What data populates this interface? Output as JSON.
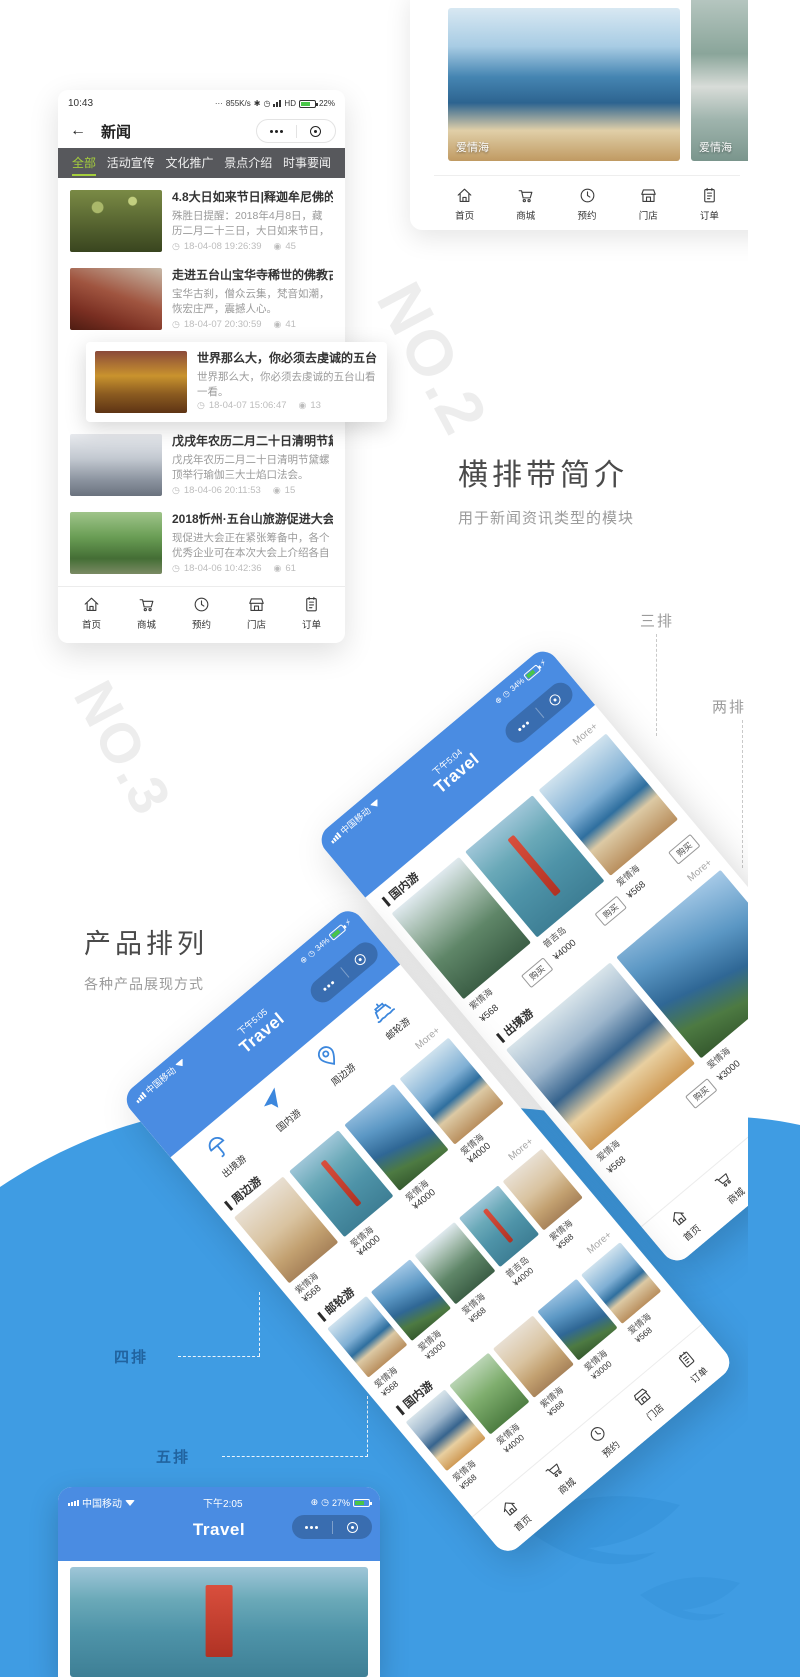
{
  "glyphs": {
    "star": "✱",
    "clock": "◷",
    "plus": "⊕",
    "eye": "◉",
    "meta_clock": "◷",
    "bolt": "⚡"
  },
  "no2": {
    "watermark": "NO.2",
    "title": "横排带简介",
    "subtitle": "用于新闻资讯类型的模块"
  },
  "no3": {
    "watermark": "NO.3",
    "title": "产品排列",
    "subtitle": "各种产品展现方式"
  },
  "annotations": {
    "three": "三排",
    "two": "两排",
    "four": "四排",
    "five": "五排"
  },
  "news_phone": {
    "status": {
      "time": "10:43",
      "dots": "···",
      "speed": "855K/s",
      "network": "HD",
      "battery": "22%"
    },
    "navbar": {
      "back": "←",
      "title": "新闻"
    },
    "tabs": [
      {
        "label": "全部"
      },
      {
        "label": "活动宣传"
      },
      {
        "label": "文化推广"
      },
      {
        "label": "景点介绍"
      },
      {
        "label": "时事要闻"
      }
    ],
    "items": [
      {
        "title": "4.8大日如来节日|释迦牟尼佛的清净报",
        "desc": "殊胜日提醒：2018年4月8日，藏历二月二十三日，大日如来节日，作何善恶成亿倍!",
        "time": "18-04-08 19:26:39",
        "views": "45"
      },
      {
        "title": "走进五台山宝华寺稀世的佛教古建筑",
        "desc": "宝华古刹，僧众云集，梵音如潮，恢宏庄严，震撼人心。",
        "time": "18-04-07 20:30:59",
        "views": "41"
      },
      {
        "title": "世界那么大，你必须去虔诚的五台山看",
        "desc": "世界那么大，你必须去虔诚的五台山看一看。",
        "time": "18-04-07 15:06:47",
        "views": "13"
      },
      {
        "title": "戊戌年农历二月二十日清明节黛螺顶举",
        "desc": "戊戌年农历二月二十日清明节黛螺顶举行瑜伽三大士焰口法会。",
        "time": "18-04-06 20:11:53",
        "views": "15"
      },
      {
        "title": "2018忻州·五台山旅游促进大会即将召",
        "desc": "现促进大会正在紧张筹备中，各个优秀企业可在本次大会上介绍各自的企业文化等，大",
        "time": "18-04-06 10:42:36",
        "views": "61"
      }
    ],
    "nav": [
      {
        "label": "首页"
      },
      {
        "label": "商城"
      },
      {
        "label": "预约"
      },
      {
        "label": "门店"
      },
      {
        "label": "订单"
      }
    ]
  },
  "gallery_phone": {
    "cards": [
      {
        "label": "爱情海"
      },
      {
        "label": "爱情海"
      }
    ],
    "nav": [
      {
        "label": "首页"
      },
      {
        "label": "商城"
      },
      {
        "label": "预约"
      },
      {
        "label": "门店"
      },
      {
        "label": "订单"
      }
    ]
  },
  "phone_a": {
    "status": {
      "carrier": "中国移动",
      "time": "下午5:04",
      "battery": "34%"
    },
    "title": "Travel",
    "sections": [
      {
        "name": "国内游",
        "more": "More+",
        "products": [
          {
            "name": "紫情海",
            "price": "¥568",
            "buy": "购买"
          },
          {
            "name": "普吉岛",
            "price": "¥4000",
            "buy": "购买"
          },
          {
            "name": "爱情海",
            "price": "¥568",
            "buy": "购买"
          }
        ]
      },
      {
        "name": "出境游",
        "more": "More+",
        "products": [
          {
            "name": "爱情海",
            "price": "¥568",
            "buy": "购买"
          },
          {
            "name": "爱情海",
            "price": "¥3000",
            "buy": "购买"
          }
        ]
      }
    ],
    "nav": [
      {
        "label": "首页"
      },
      {
        "label": "商城"
      },
      {
        "label": "预约"
      },
      {
        "label": "门店"
      },
      {
        "label": "订单"
      }
    ]
  },
  "phone_b": {
    "status": {
      "carrier": "中国移动",
      "time": "下午5:05",
      "battery": "34%"
    },
    "title": "Travel",
    "categories": [
      {
        "label": "出境游"
      },
      {
        "label": "国内游"
      },
      {
        "label": "周边游"
      },
      {
        "label": "邮轮游"
      }
    ],
    "sections": [
      {
        "name": "周边游",
        "more": "More+",
        "products": [
          {
            "name": "紫情海",
            "price": "¥568"
          },
          {
            "name": "爱情海",
            "price": "¥4000"
          },
          {
            "name": "爱情海",
            "price": "¥4000"
          },
          {
            "name": "爱情海",
            "price": "¥4000"
          }
        ]
      },
      {
        "name": "邮轮游",
        "more": "More+",
        "products": [
          {
            "name": "爱情海",
            "price": "¥568"
          },
          {
            "name": "爱情海",
            "price": "¥3000"
          },
          {
            "name": "爱情海",
            "price": "¥568"
          },
          {
            "name": "普吉岛",
            "price": "¥4000"
          },
          {
            "name": "紫情海",
            "price": "¥568"
          }
        ]
      },
      {
        "name": "国内游",
        "more": "More+",
        "products": [
          {
            "name": "爱情海",
            "price": "¥568"
          },
          {
            "name": "爱情海",
            "price": "¥4000"
          },
          {
            "name": "紫情海",
            "price": "¥568"
          },
          {
            "name": "爱情海",
            "price": "¥3000"
          },
          {
            "name": "爱情海",
            "price": "¥568"
          }
        ]
      }
    ],
    "nav": [
      {
        "label": "首页"
      },
      {
        "label": "商城"
      },
      {
        "label": "预约"
      },
      {
        "label": "门店"
      },
      {
        "label": "订单"
      }
    ]
  },
  "phone_c": {
    "status": {
      "carrier": "中国移动",
      "time": "下午2:05",
      "battery": "27%"
    },
    "title": "Travel"
  }
}
